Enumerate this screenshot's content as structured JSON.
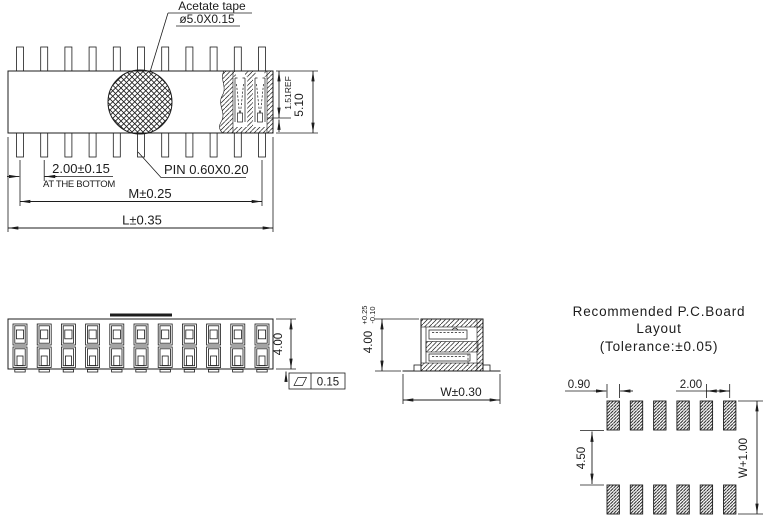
{
  "colors": {
    "line": "#1c1c1c",
    "background": "#ffffff"
  },
  "top_view": {
    "tape_label": "Acetate tape",
    "tape_spec": "ø5.0X0.15",
    "pitch_dim": "2.00±0.15",
    "pitch_note": "AT THE BOTTOM",
    "pin_spec": "PIN  0.60X0.20",
    "dim_m": "M±0.25",
    "dim_l": "L±0.35",
    "dim_ref": "1.51REF",
    "dim_height": "5.10",
    "pins_per_row": 11
  },
  "front_view": {
    "dim_height": "4.00",
    "flatness_tol": "0.15",
    "columns": 11,
    "rows": 2
  },
  "side_view": {
    "dim_height": "4.00",
    "tol_plus": "+0.25",
    "tol_minus": "-0.10",
    "dim_width": "W±0.30"
  },
  "pcb_layout": {
    "title1": "Recommended P.C.Board",
    "title2": "Layout",
    "title3": "(Tolerance:±0.05)",
    "dim_pad_width": "0.90",
    "dim_pitch": "2.00",
    "dim_row_gap": "4.50",
    "dim_overall": "W+1.00",
    "pads_per_row": 6,
    "rows": 2
  }
}
